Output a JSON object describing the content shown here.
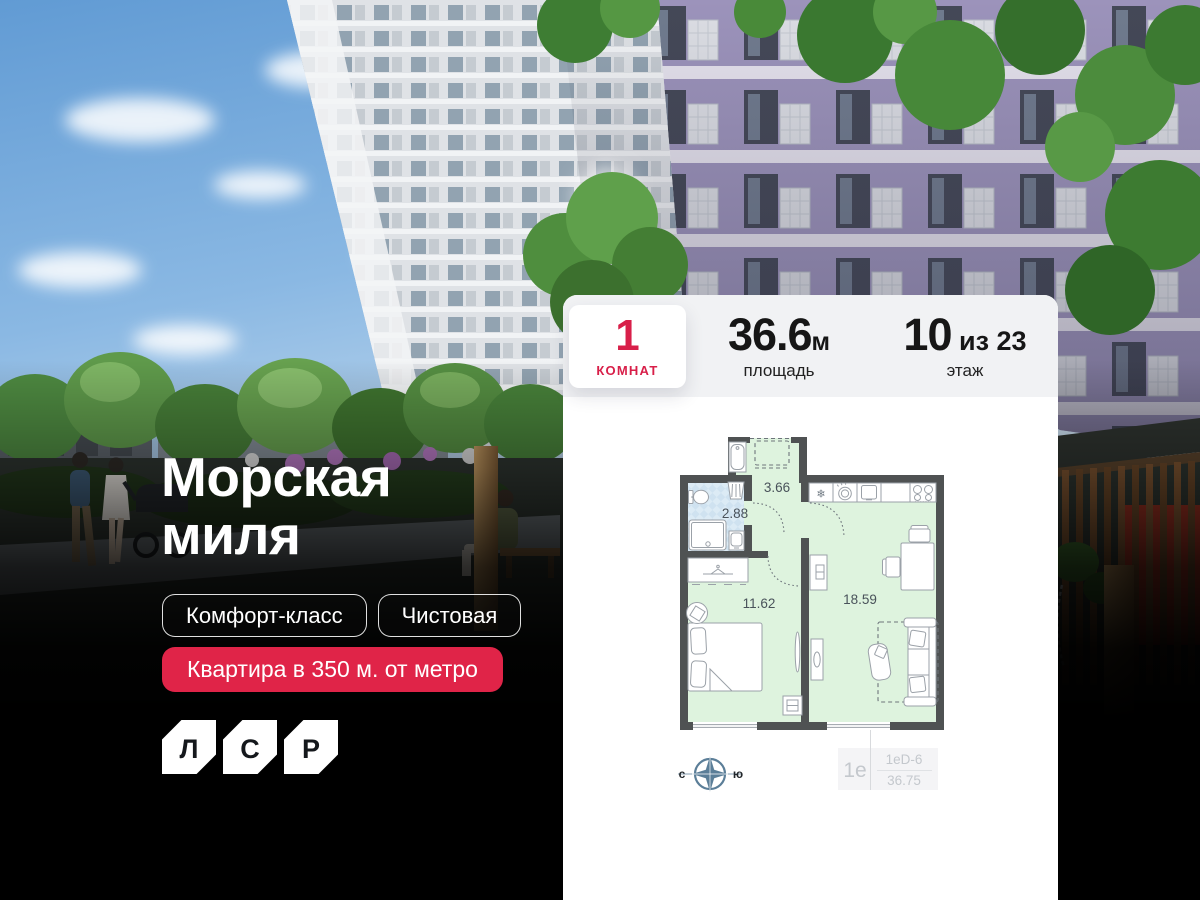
{
  "colors": {
    "accent_red": "#e02448",
    "stats_red": "#d81f49",
    "plan_wall": "#4f5253",
    "plan_room_fill": "#def3de",
    "plan_bath_fill": "#dcebf5",
    "compass_blue": "#5b7e98"
  },
  "brand": {
    "name": "ЛСР",
    "logo_letters": [
      "Л",
      "С",
      "Р"
    ]
  },
  "hero": {
    "title_line1": "Морская",
    "title_line2": "миля",
    "tags": [
      {
        "label": "Комфорт-класс"
      },
      {
        "label": "Чистовая"
      }
    ],
    "badge": "Квартира в 350 м. от метро"
  },
  "card": {
    "rooms": {
      "value": "1",
      "label": "КОМНАТ"
    },
    "area": {
      "value": "36.6",
      "unit": "м",
      "label": "площадь"
    },
    "floor": {
      "value": "10",
      "suffix": "из 23",
      "label": "этаж"
    },
    "plan": {
      "room_areas": {
        "hall": "3.66",
        "bathroom": "2.88",
        "bedroom": "11.62",
        "living_kitchen": "18.59"
      },
      "compass": {
        "north": "с",
        "south": "ю"
      },
      "unit_id": {
        "type": "1е",
        "layout_code": "1еD-6",
        "total_area": "36.75"
      }
    }
  }
}
